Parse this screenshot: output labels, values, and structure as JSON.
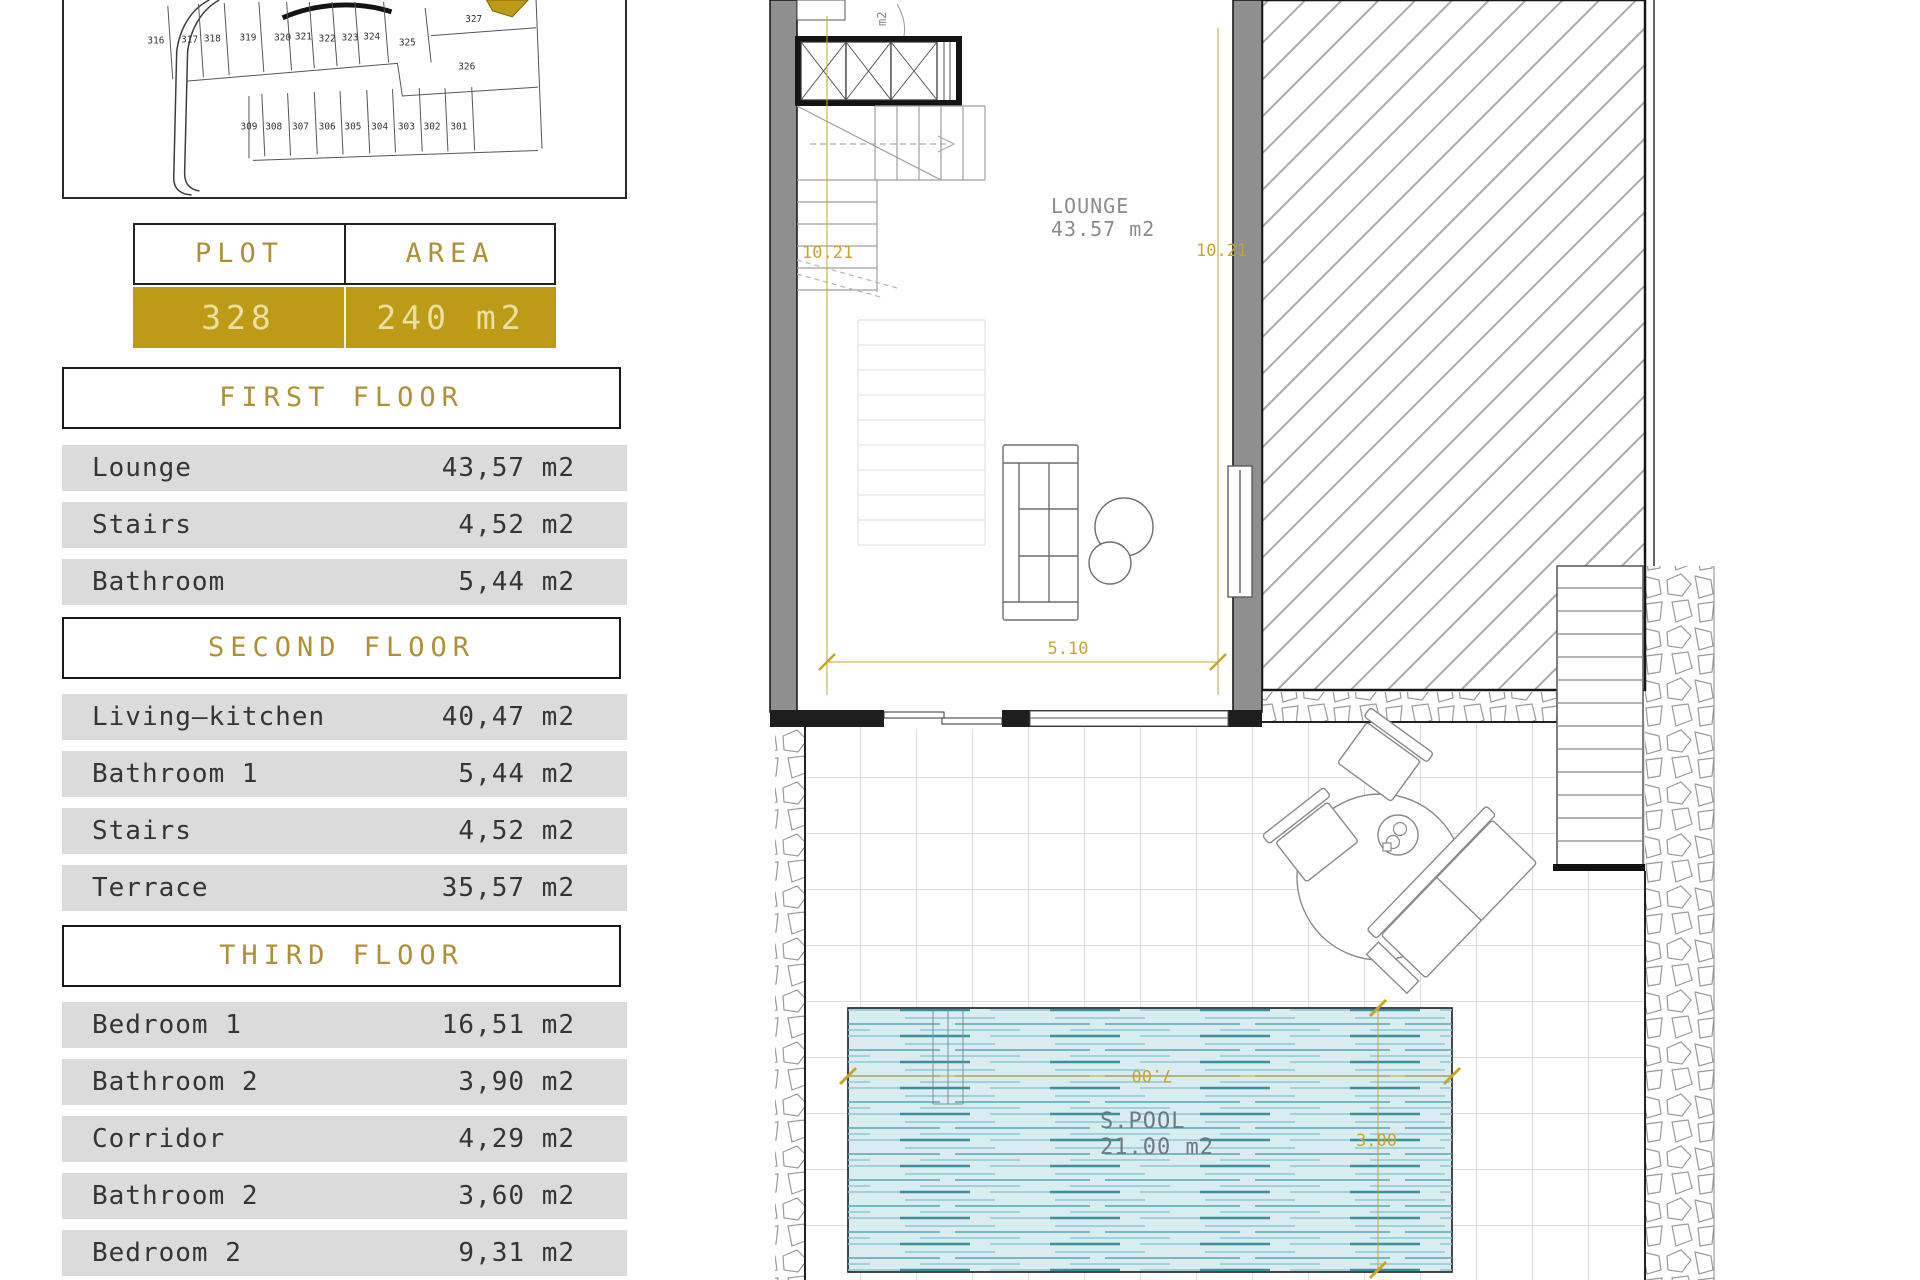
{
  "colors": {
    "gold_fill": "#BE9B16",
    "gold_header_text": "#AE9137",
    "gold_value_text": "#EBDFA4",
    "dim_gold": "#C7A52B",
    "row_bg": "#DBDBDB",
    "pool_water": "#D9EDF1"
  },
  "site_plan": {
    "highlighted_plot": "328",
    "plot_labels": [
      "316",
      "317",
      "318",
      "319",
      "320",
      "321",
      "322",
      "323",
      "324",
      "325",
      "326",
      "327",
      "309",
      "308",
      "307",
      "306",
      "305",
      "304",
      "303",
      "302",
      "301"
    ]
  },
  "plot_table": {
    "col1_header": "PLOT",
    "col2_header": "AREA (SIZE)",
    "plot_number": "328",
    "area_value": "240 m2"
  },
  "sections": [
    {
      "title": "FIRST FLOOR",
      "rooms": [
        {
          "name": "Lounge",
          "area": "43,57 m2"
        },
        {
          "name": "Stairs",
          "area": "4,52 m2"
        },
        {
          "name": "Bathroom",
          "area": "5,44 m2"
        }
      ]
    },
    {
      "title": "SECOND FLOOR",
      "rooms": [
        {
          "name": "Living—kitchen",
          "area": "40,47 m2"
        },
        {
          "name": "Bathroom 1",
          "area": "5,44 m2"
        },
        {
          "name": "Stairs",
          "area": "4,52 m2"
        },
        {
          "name": "Terrace",
          "area": "35,57 m2"
        }
      ]
    },
    {
      "title": "THIRD FLOOR",
      "rooms": [
        {
          "name": "Bedroom 1",
          "area": "16,51 m2"
        },
        {
          "name": "Bathroom 2",
          "area": "3,90 m2"
        },
        {
          "name": "Corridor",
          "area": "4,29 m2"
        },
        {
          "name": "Bathroom 2",
          "area": "3,60 m2"
        },
        {
          "name": "Bedroom 2",
          "area": "9,31 m2"
        }
      ]
    }
  ],
  "floor_plan": {
    "lounge": {
      "label": "LOUNGE",
      "area": "43.57 m2"
    },
    "pool": {
      "label": "S.POOL",
      "area": "21.00 m2",
      "width_dim": "7.00",
      "depth_dim": "3.00"
    },
    "dims": {
      "left_height": "10.21",
      "right_height": "10.21",
      "bottom_width": "5.10"
    },
    "stairs_note": "m2"
  }
}
